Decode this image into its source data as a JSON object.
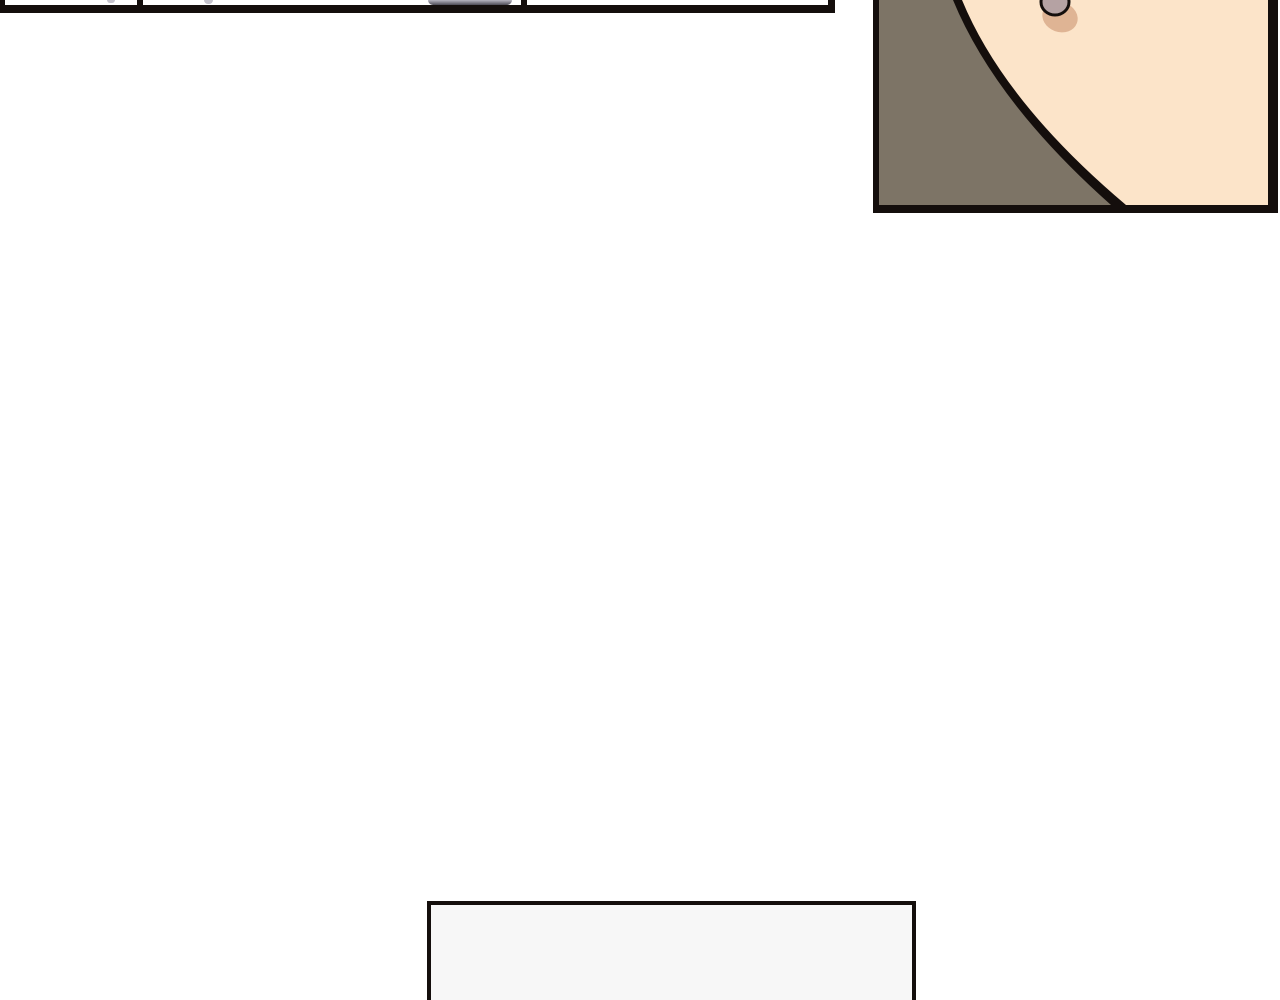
{
  "page": {
    "kind": "webtoon-comic-page",
    "text_content": "none"
  },
  "colors": {
    "page_bg": "#ffffff",
    "ink": "#140e0c",
    "panel_bg": "#7d7466",
    "skin": "#fce4c9",
    "nose_fill": "#b5a2a3",
    "nose_shadow": "#dfb494",
    "bubble": "#b7b5c1",
    "bubble_dark": "#4e4b56",
    "speck": "#c4c2cc",
    "box_fill": "#f7f7f7"
  },
  "panels": {
    "row_sliver": {
      "label": "bottom edge of three comic panels with speech-bubble tip"
    },
    "face_panel": {
      "label": "close-up of cheek and jawline on brown background"
    },
    "caption_box": {
      "label": "empty light-gray bordered box"
    }
  }
}
